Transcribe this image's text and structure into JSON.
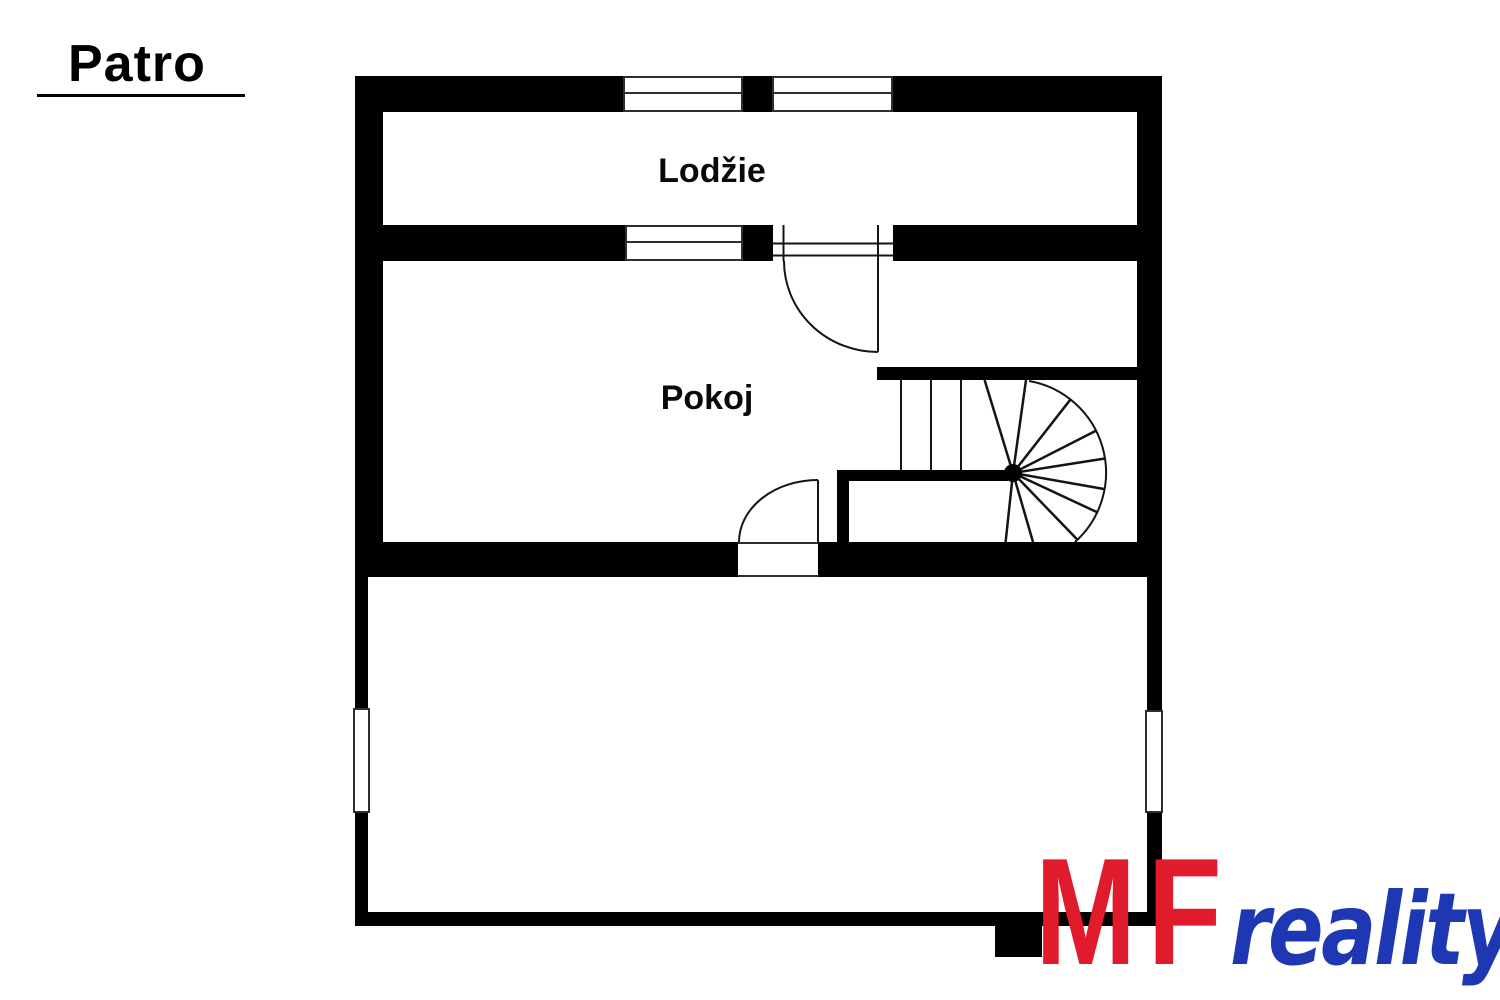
{
  "page_title": "Patro",
  "rooms": {
    "loggia": "Lodžie",
    "bedroom": "Pokoj"
  },
  "logo": {
    "initials": "MF",
    "word": "reality",
    "colors": {
      "initials": "#e01b2c",
      "word": "#1e38b4"
    }
  },
  "plan_colors": {
    "wall": "#000000",
    "line": "#141414"
  }
}
